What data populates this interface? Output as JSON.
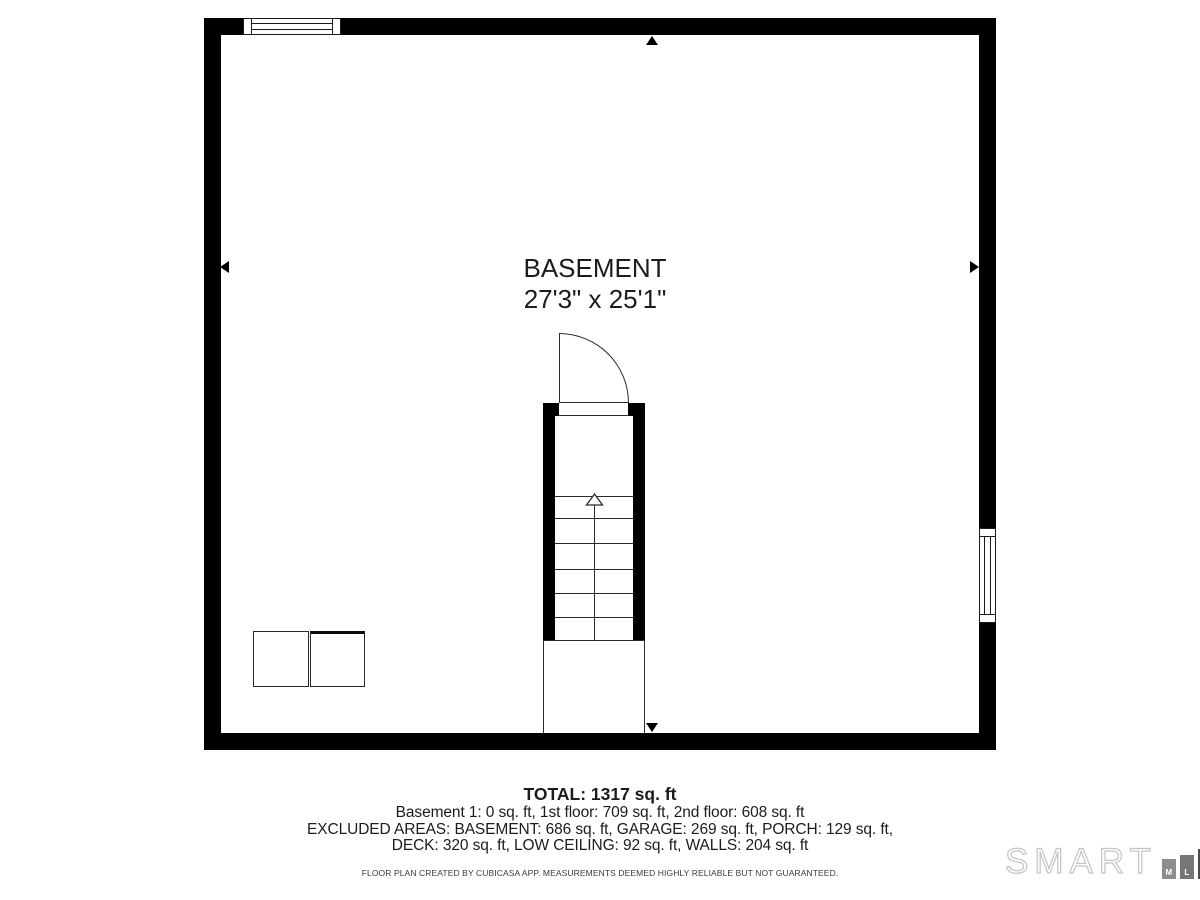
{
  "plan": {
    "room_label": "BASEMENT",
    "room_dimensions": "27'3\" x 25'1\""
  },
  "summary": {
    "total": "TOTAL: 1317 sq. ft",
    "floors": "Basement 1: 0 sq. ft, 1st floor: 709 sq. ft, 2nd floor: 608 sq. ft",
    "excluded_line1": "EXCLUDED AREAS: BASEMENT: 686 sq. ft, GARAGE: 269 sq. ft, PORCH: 129 sq. ft,",
    "excluded_line2": "DECK: 320 sq. ft, LOW CEILING: 92 sq. ft, WALLS: 204 sq. ft",
    "disclaimer": "FLOOR PLAN CREATED BY CUBICASA APP. MEASUREMENTS DEEMED HIGHLY RELIABLE BUT NOT GUARANTEED."
  },
  "logo": {
    "brand": "SMART",
    "blocks": [
      {
        "letter": "M",
        "color": "#8d8d8d"
      },
      {
        "letter": "L",
        "color": "#767676"
      },
      {
        "letter": "S",
        "color": "#4a4a4a"
      }
    ]
  },
  "colors": {
    "wall": "#000000",
    "thin_line": "#2b2b2b",
    "text": "#1c1c1c",
    "logo_outline": "#c4c4c4"
  }
}
